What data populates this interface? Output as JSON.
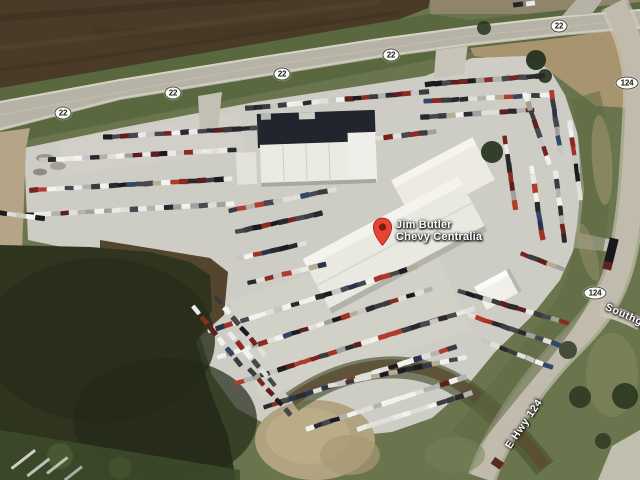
{
  "map": {
    "place_label": {
      "line1": "Jim Butler",
      "line2": "Chevy Centralia"
    },
    "marker_color": "#EA4335",
    "marker_dot_color": "#7E1D12",
    "route_shields": [
      {
        "label": "22",
        "x": 63,
        "y": 113
      },
      {
        "label": "22",
        "x": 173,
        "y": 93
      },
      {
        "label": "22",
        "x": 282,
        "y": 74
      },
      {
        "label": "22",
        "x": 391,
        "y": 55
      },
      {
        "label": "22",
        "x": 559,
        "y": 26
      },
      {
        "label": "124",
        "x": 627,
        "y": 83
      },
      {
        "label": "124",
        "x": 595,
        "y": 293
      }
    ],
    "road_labels": [
      {
        "id": "e-hwy-124",
        "label": "E Hwy 124",
        "x": 524,
        "y": 424,
        "angle": -56
      },
      {
        "id": "southgate",
        "label": "Southga",
        "x": 627,
        "y": 316,
        "angle": 24
      }
    ]
  }
}
